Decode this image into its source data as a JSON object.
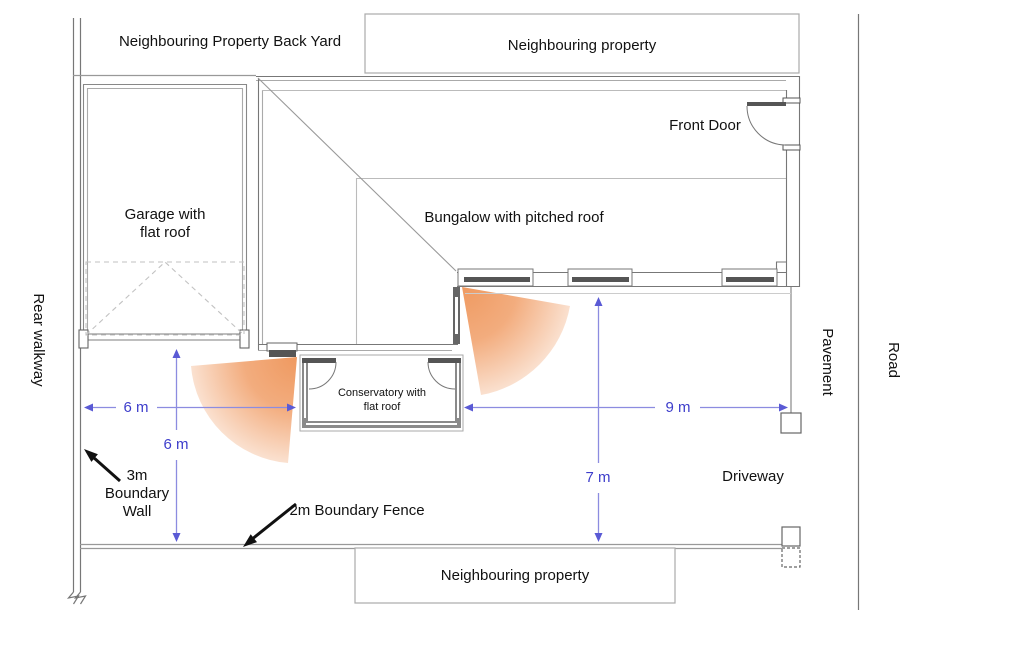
{
  "diagram": {
    "type": "residential site plan",
    "areas": {
      "back_yard": "Neighbouring Property Back Yard",
      "neighbour_top": "Neighbouring property",
      "neighbour_bottom": "Neighbouring property",
      "rear_walkway": "Rear walkway",
      "pavement": "Pavement",
      "road": "Road",
      "driveway": "Driveway"
    },
    "buildings": {
      "garage": {
        "label_line1": "Garage with",
        "label_line2": "flat roof"
      },
      "bungalow": {
        "label": "Bungalow with pitched roof",
        "front_door": "Front Door"
      },
      "conservatory": {
        "label_line1": "Conservatory with",
        "label_line2": "flat roof"
      }
    },
    "boundaries": {
      "wall_line1": "3m",
      "wall_line2": "Boundary",
      "wall_line3": "Wall",
      "fence": "2m Boundary Fence"
    },
    "dimensions": {
      "rear_garden_width": "6 m",
      "rear_garden_depth": "6 m",
      "driveway_width": "9 m",
      "driveway_depth": "7 m"
    },
    "colors": {
      "dimension_line": "#8c8ce0",
      "dimension_text": "#3d3dcb",
      "sensor_fan_inner": "#ee9458",
      "sensor_fan_outer": "#fadfcd",
      "wall_dark": "#555555",
      "outline_gray": "#888888"
    }
  }
}
